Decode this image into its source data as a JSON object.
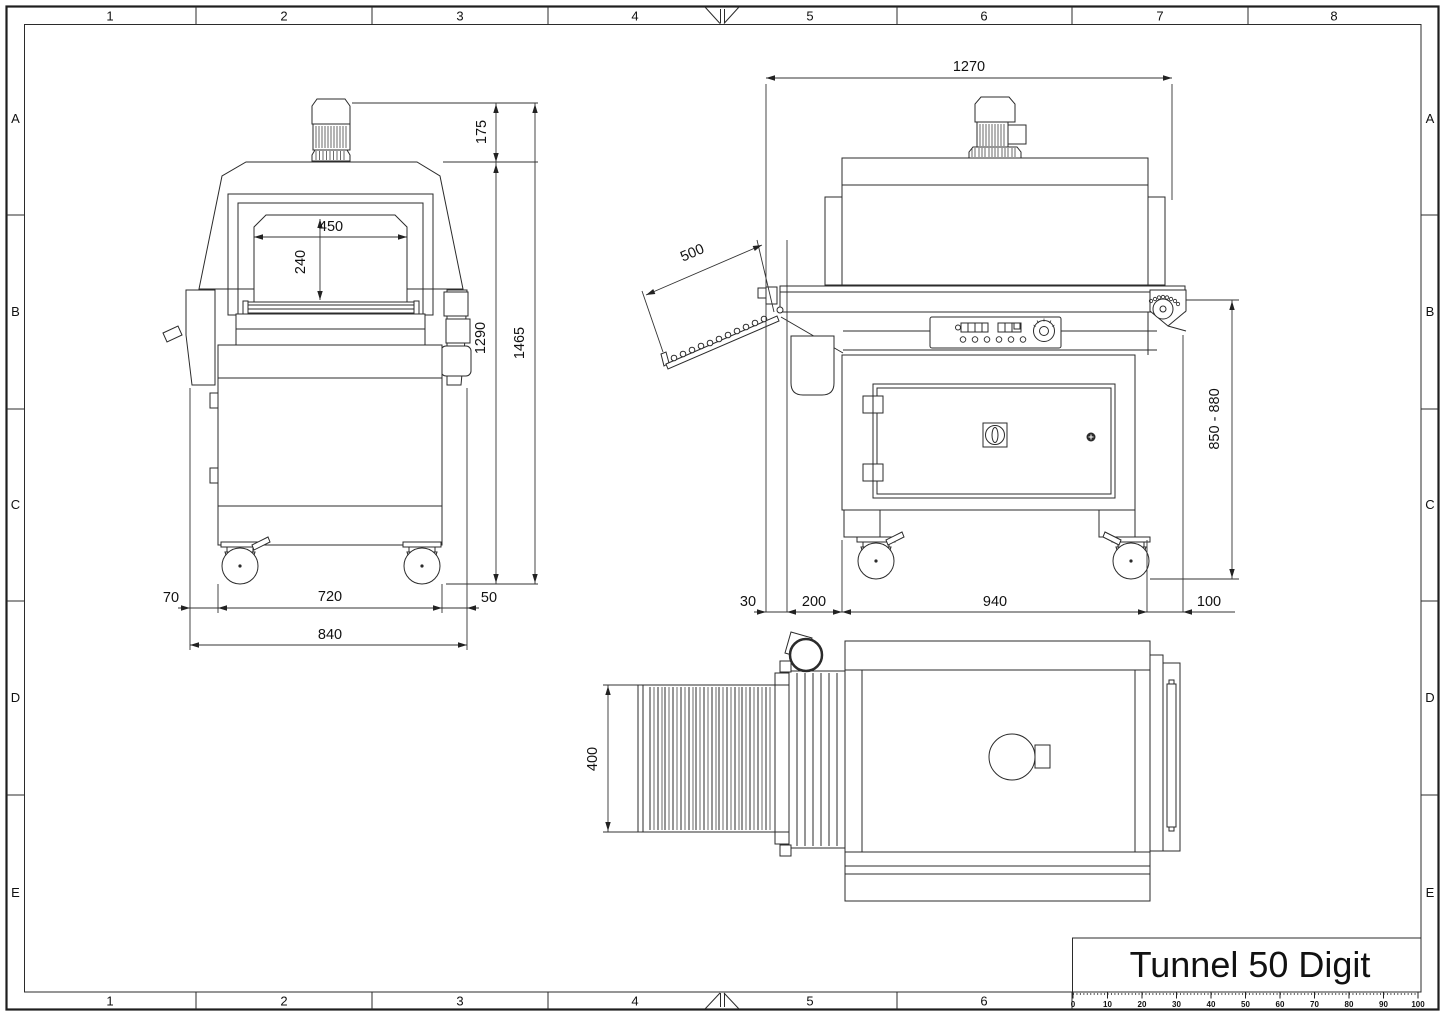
{
  "drawing": {
    "title": "Tunnel 50 Digit"
  },
  "grid": {
    "cols_top": [
      "1",
      "2",
      "3",
      "4",
      "5",
      "6",
      "7",
      "8"
    ],
    "cols_bottom": [
      "1",
      "2",
      "3",
      "4",
      "5",
      "6"
    ],
    "rows_left": [
      "A",
      "B",
      "C",
      "D",
      "E"
    ],
    "rows_right": [
      "A",
      "B",
      "C",
      "D",
      "E"
    ]
  },
  "ruler": {
    "labels": [
      "0",
      "10",
      "20",
      "30",
      "40",
      "50",
      "60",
      "70",
      "80",
      "90",
      "100"
    ]
  },
  "dims": {
    "front": {
      "opening_width": "450",
      "opening_height": "240",
      "motor_height": "175",
      "tunnel_height": "1290",
      "total_height": "1465",
      "left_offset": "70",
      "base_width": "720",
      "right_offset": "50",
      "overall_width": "840"
    },
    "side": {
      "overall_length": "1270",
      "tray_length": "500",
      "rear_offset": "30",
      "tray_overhang": "200",
      "base_length": "940",
      "front_overhang": "100",
      "working_height": "850 - 880"
    },
    "top": {
      "conveyor_width": "400"
    }
  }
}
